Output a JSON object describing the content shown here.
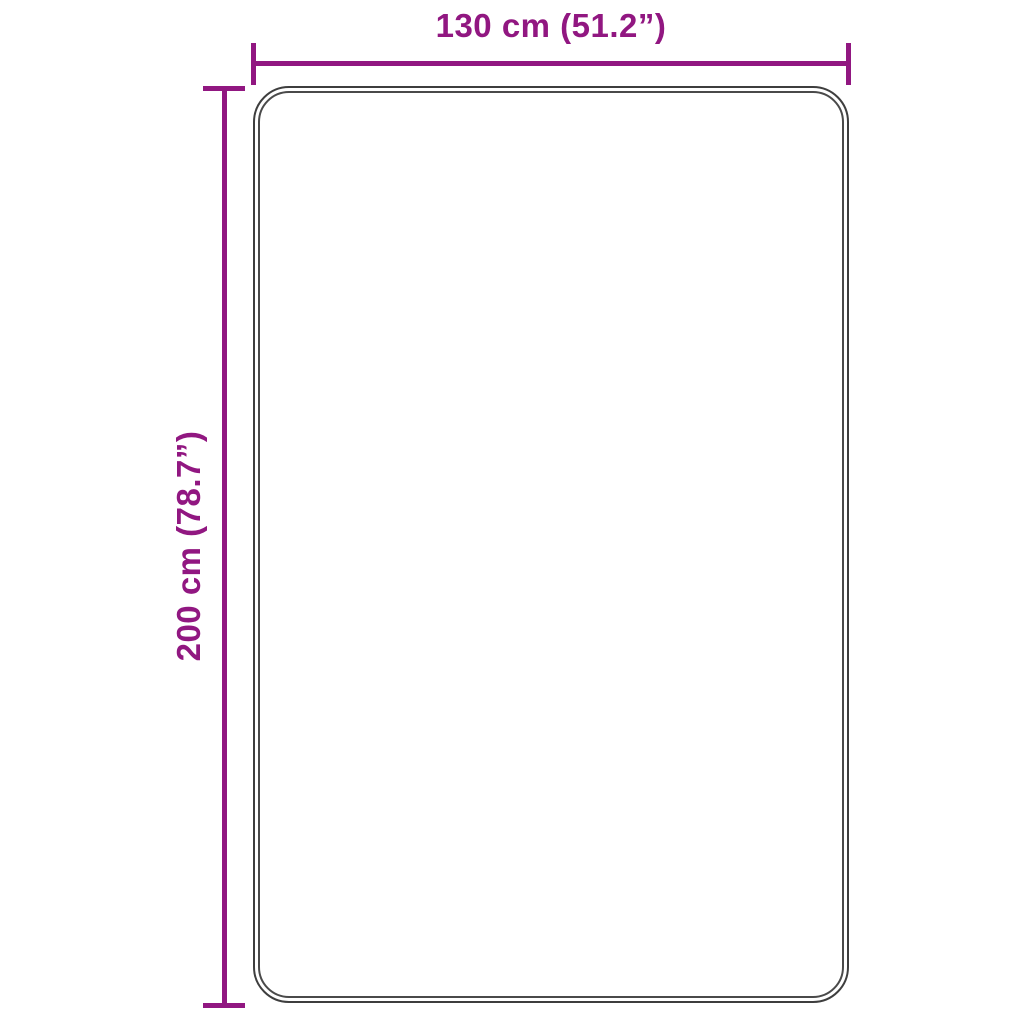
{
  "diagram": {
    "type": "product-dimension-diagram",
    "width_label": "130 cm (51.2”)",
    "height_label": "200 cm (78.7”)",
    "accent_color": "#911781",
    "outline_color": "#3e3e3e",
    "background_color": "#ffffff"
  }
}
